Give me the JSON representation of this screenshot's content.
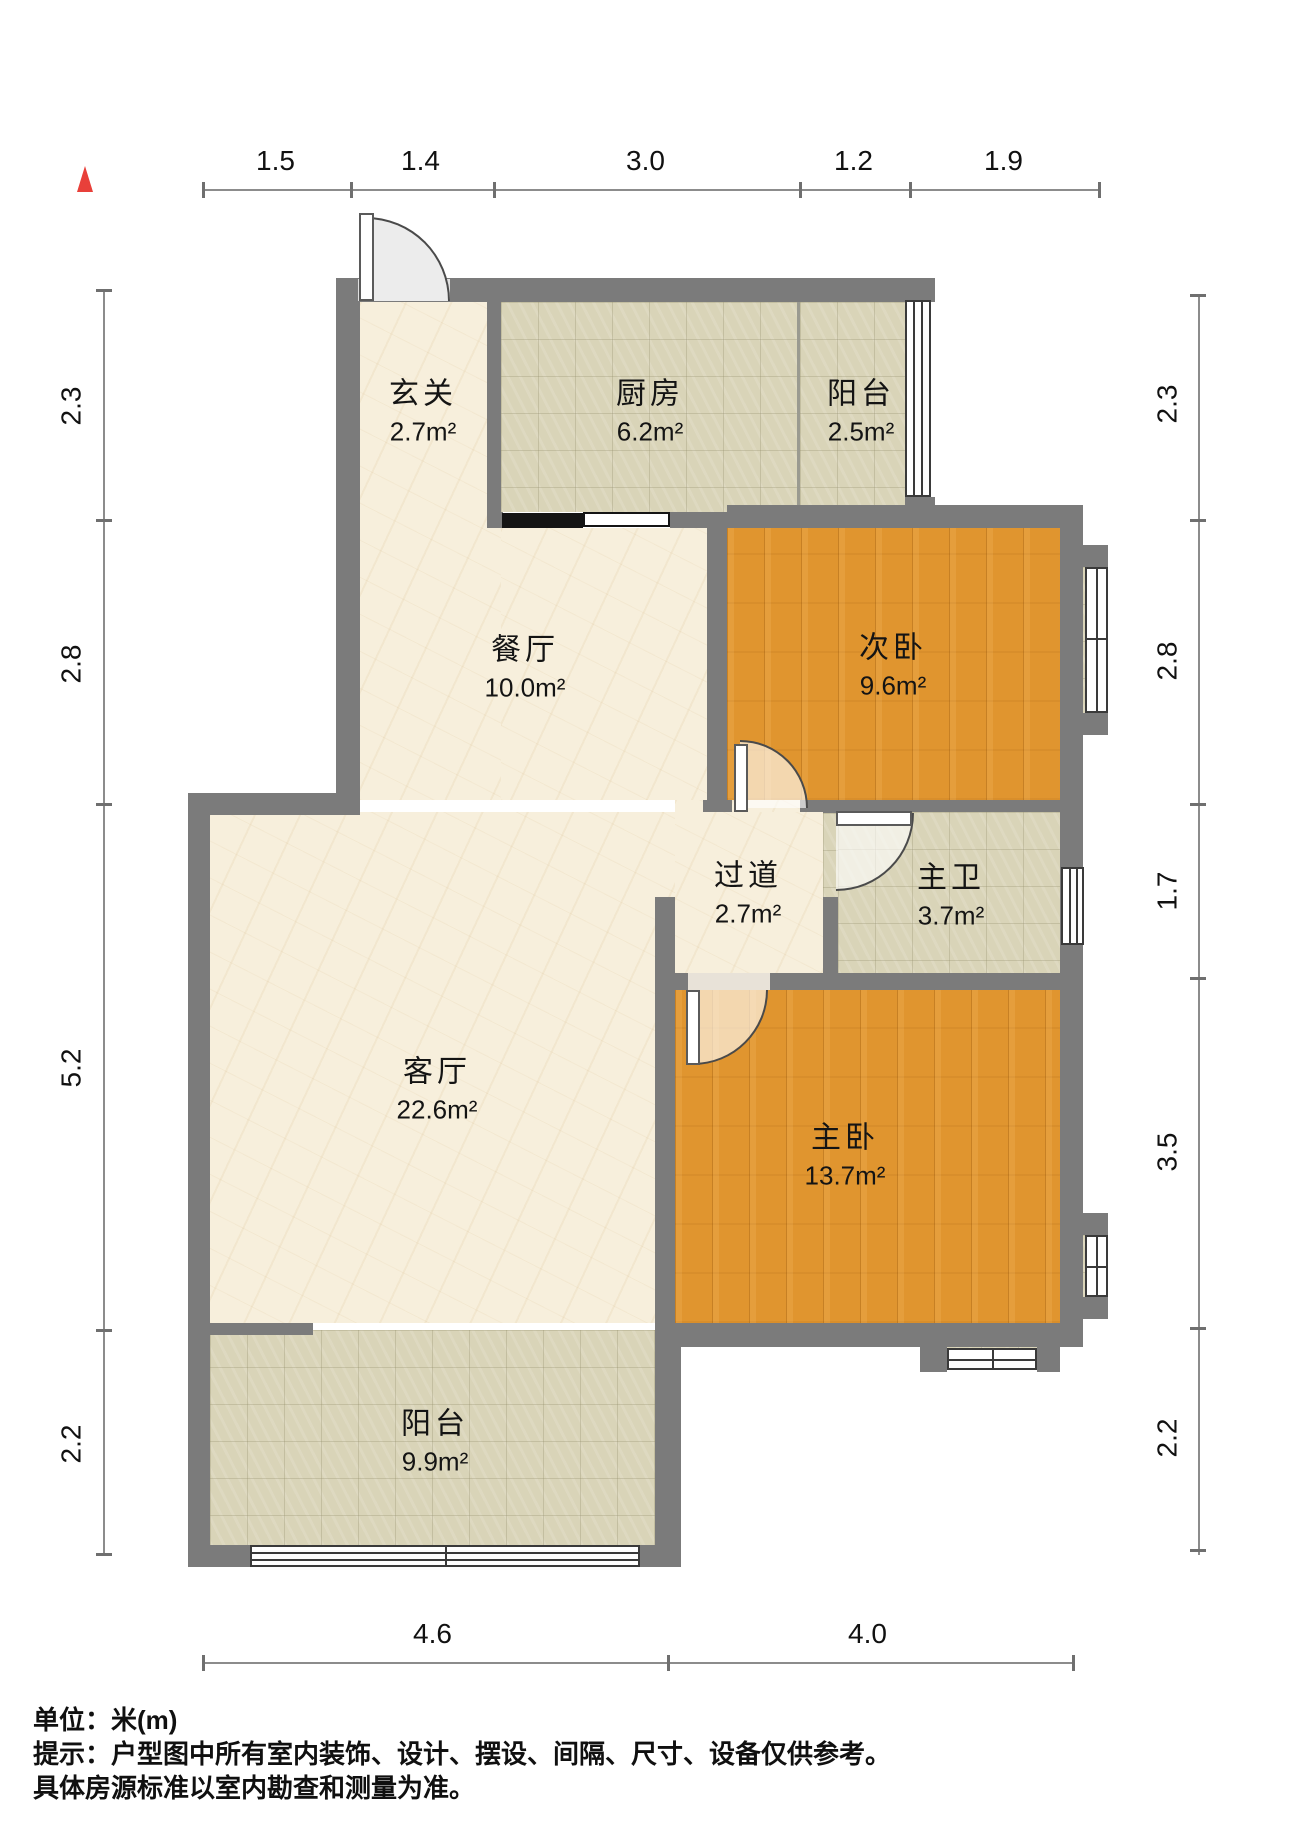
{
  "title": "户型图",
  "unit_note": "单位：米(m)",
  "dims": {
    "top": [
      "1.5",
      "1.4",
      "3.0",
      "1.2",
      "1.9"
    ],
    "left": [
      "2.3",
      "2.8",
      "5.2",
      "2.2"
    ],
    "right": [
      "2.3",
      "2.8",
      "1.7",
      "3.5",
      "2.2"
    ],
    "bottom": [
      "4.6",
      "4.0"
    ]
  },
  "rooms": [
    {
      "name": "玄关",
      "area": "2.7m²"
    },
    {
      "name": "厨房",
      "area": "6.2m²"
    },
    {
      "name": "阳台",
      "area": "2.5m²"
    },
    {
      "name": "餐厅",
      "area": "10.0m²"
    },
    {
      "name": "次卧",
      "area": "9.6m²"
    },
    {
      "name": "过道",
      "area": "2.7m²"
    },
    {
      "name": "主卫",
      "area": "3.7m²"
    },
    {
      "name": "客厅",
      "area": "22.6m²"
    },
    {
      "name": "主卧",
      "area": "13.7m²"
    },
    {
      "name": "阳台",
      "area": "9.9m²"
    }
  ],
  "footer": {
    "line1": "单位：米(m)",
    "line2": "提示：户型图中所有室内装饰、设计、摆设、间隔、尺寸、设备仅供参考。",
    "line3": "具体房源标准以室内勘查和测量为准。"
  },
  "colors": {
    "wall": "#7b7b7b",
    "wood_floor": "#e0952f",
    "tile_floor": "#d9d4b8",
    "marble_floor": "#f7efdc",
    "north_arrow": "#e8403a",
    "sliding_door_track": "#141414"
  }
}
